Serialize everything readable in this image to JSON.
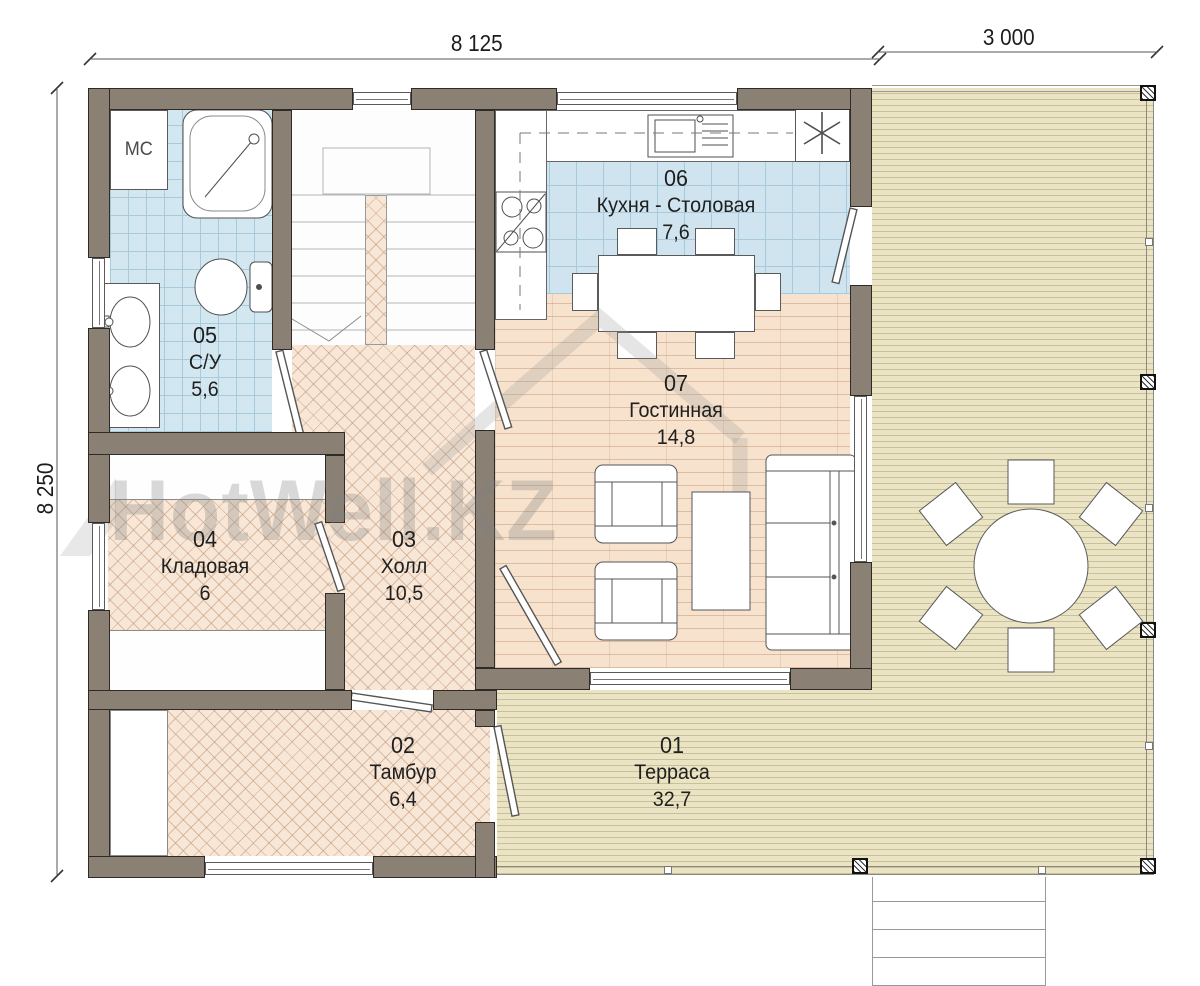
{
  "dimensions": {
    "house_width": "8 125",
    "terrace_width": "3 000",
    "house_depth": "8 250"
  },
  "watermark": {
    "text": "HotWell.KZ"
  },
  "labels": {
    "washing_machine": "МС"
  },
  "rooms": [
    {
      "number": "01",
      "name": "Терраса",
      "area": "32,7"
    },
    {
      "number": "02",
      "name": "Тамбур",
      "area": "6,4"
    },
    {
      "number": "03",
      "name": "Холл",
      "area": "10,5"
    },
    {
      "number": "04",
      "name": "Кладовая",
      "area": "6"
    },
    {
      "number": "05",
      "name": "С/У",
      "area": "5,6"
    },
    {
      "number": "06",
      "name": "Кухня - Столовая",
      "area": "7,6"
    },
    {
      "number": "07",
      "name": "Гостинная",
      "area": "14,8"
    }
  ],
  "colors": {
    "wall": "#8a8074",
    "bath_tile": "#d3e7f0",
    "kitchen_tile": "#cfe4ef",
    "parquet": "#f8e7d6",
    "plank": "#f6e2cd",
    "deck": "#eae4c4"
  }
}
